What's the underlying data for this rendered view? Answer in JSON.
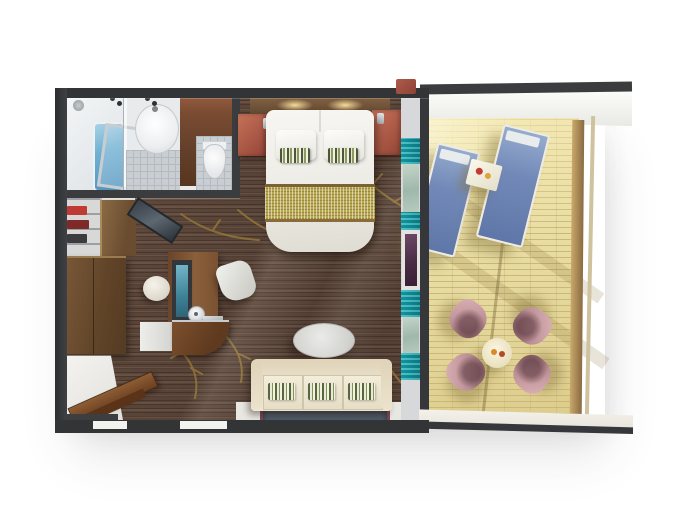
{
  "scene": {
    "title": "Suite floor plan 3D render",
    "type": "top-down 3D architectural rendering of a suite with balcony",
    "background": "#ffffff"
  },
  "palette": {
    "wall_dark": "#35373a",
    "carpet_brown": "#5c463a",
    "branch_gold": "#96783a",
    "bathroom_tile": "#c9ced3",
    "bathtub_blue": "#6fb0d2",
    "door_wood": "#6b4733",
    "nightstand_terracotta": "#b2604e",
    "bed_white": "#f3f2ee",
    "bed_runner_gold": "#b9a852",
    "curtain_teal": "#17b3be",
    "window_purple": "#5c3a55",
    "furniture_wood": "#7a5434",
    "tv_screen_teal": "#4a8fa6",
    "sofa_cream": "#e9dfc9",
    "pillow_stripe_green": "#55683f",
    "rug_navy": "#4e5b68",
    "rug_border_maroon": "#7a4656",
    "deck_wood": "#e9dda2",
    "lounger_blue": "#7289b8",
    "balcony_chair_pink": "#bb8f96",
    "balcony_table_cream": "#e9e0be",
    "ledge_white": "#f1efe8"
  },
  "regions": {
    "bathroom": {
      "label": "Bathroom"
    },
    "bedroom": {
      "label": "Bedroom"
    },
    "living_area": {
      "label": "Living area"
    },
    "entry": {
      "label": "Entry"
    },
    "balcony": {
      "label": "Balcony"
    }
  },
  "furniture": {
    "shower": "Shower with tub",
    "sink": "Washbasin",
    "toilet": "Toilet",
    "bathroom_door": "Bathroom door",
    "bed": "Double bed",
    "headboard": "Headboard with lights",
    "nightstand": "Nightstand",
    "wardrobe": "Wardrobe",
    "closet_shelves": "Closet shelves",
    "mirror": "Leaning mirror",
    "desk": "Desk with TV",
    "tv": "TV screen",
    "lamp": "Desk lamp",
    "desk_chair": "Desk chair",
    "ottoman": "Ottoman",
    "counter": "Curved counter",
    "sofa": "Sofa with striped pillows",
    "coffee_table": "Oval coffee table",
    "rug": "Rug",
    "entry_door": "Entry door",
    "divider": "Glass wall with teal curtains",
    "lounger": "Sun lounger",
    "side_table": "Balcony side table",
    "dining_table": "Balcony round table",
    "balcony_chair": "Balcony chair",
    "deck": "Balcony deck",
    "railing": "Glass railing"
  }
}
